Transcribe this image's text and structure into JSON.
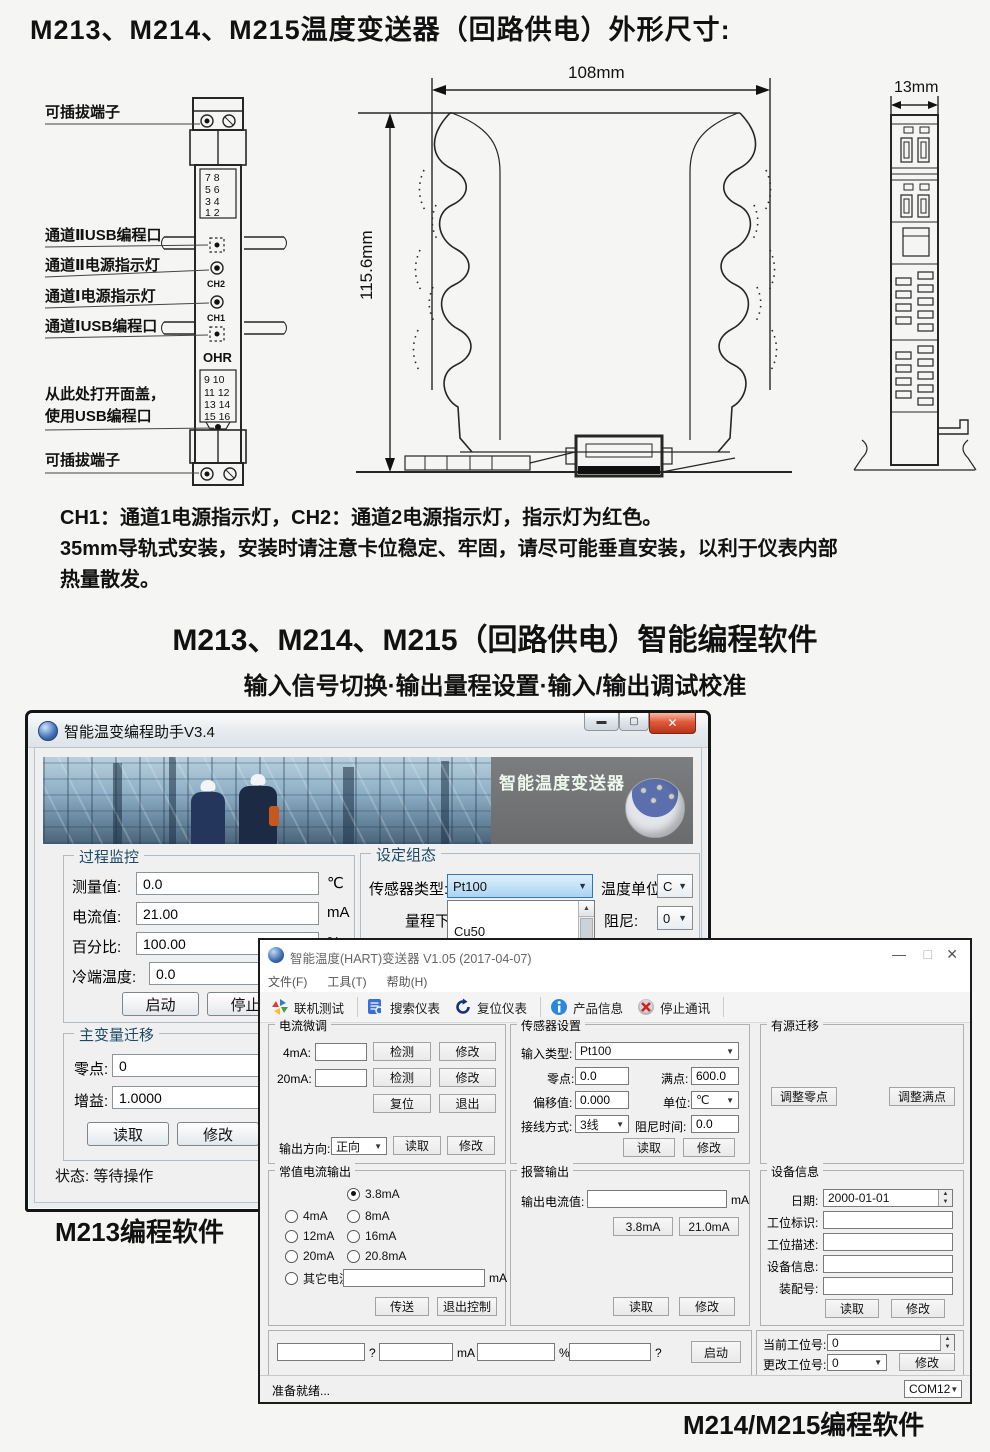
{
  "page": {
    "title": "M213、M214、M215温度变送器（回路供电）外形尺寸:",
    "notes": [
      "CH1：通道1电源指示灯，CH2：通道2电源指示灯，指示灯为红色。",
      "35mm导轨式安装，安装时请注意卡位稳定、牢固，请尽可能垂直安装，以利于仪表内部",
      "热量散发。"
    ],
    "software_title": "M213、M214、M215（回路供电）智能编程软件",
    "software_subtitle": "输入信号切换·输出量程设置·输入/输出调试校准",
    "caption_m213": "M213编程软件",
    "caption_m214": "M214/M215编程软件"
  },
  "diagram": {
    "dim_width": "108mm",
    "dim_height": "115.6mm",
    "dim_side": "13mm",
    "labels": {
      "plug_top": "可插拔端子",
      "ch2_usb": "通道ⅡUSB编程口",
      "ch2_led": "通道Ⅱ电源指示灯",
      "ch1_led": "通道Ⅰ电源指示灯",
      "ch1_usb": "通道ⅠUSB编程口",
      "open_cover1": "从此处打开面盖，",
      "open_cover2": "使用USB编程口",
      "plug_bottom": "可插拔端子"
    },
    "module": {
      "ch2": "CH2",
      "ch1": "CH1",
      "logo": "OHR",
      "top_terms": [
        "7   8",
        "5   6",
        "3   4",
        "1   2"
      ],
      "bot_terms": [
        "9   10",
        "11  12",
        "13  14",
        "15  16"
      ]
    }
  },
  "win1": {
    "title": "智能温变编程助手V3.4",
    "banner_caption": "智能温度变送器",
    "monitor": {
      "legend": "过程监控",
      "rows": [
        {
          "label": "测量值:",
          "value": "0.0",
          "unit": "℃"
        },
        {
          "label": "电流值:",
          "value": "21.00",
          "unit": "mA"
        },
        {
          "label": "百分比:",
          "value": "100.00",
          "unit": "%"
        },
        {
          "label": "冷端温度:",
          "value": "0.0",
          "unit": ""
        }
      ],
      "btn_start": "启动",
      "btn_stop": "停止"
    },
    "config": {
      "legend": "设定组态",
      "sensor_label": "传感器类型:",
      "sensor_value": "Pt100",
      "unit_label": "温度单位",
      "unit_value": "C",
      "range_label": "量程下限:",
      "damp_label": "阻尼:",
      "damp_value": "0",
      "list_items": [
        "Cu50",
        "Pt100"
      ]
    },
    "shift": {
      "legend": "主变量迁移",
      "zero_label": "零点:",
      "zero_value": "0",
      "gain_label": "增益:",
      "gain_value": "1.0000",
      "btn_read": "读取",
      "btn_modify": "修改"
    },
    "status_label": "状态:",
    "status_value": "等待操作"
  },
  "win2": {
    "title": "智能温度(HART)变送器 V1.05 (2017-04-07)",
    "controls": {
      "min": "—",
      "max": "□",
      "close": "✕"
    },
    "menus": [
      "文件(F)",
      "工具(T)",
      "帮助(H)"
    ],
    "toolbar": [
      "联机测试",
      "搜索仪表",
      "复位仪表",
      "产品信息",
      "停止通讯"
    ],
    "trim": {
      "legend": "电流微调",
      "r1_label": "4mA:",
      "r2_label": "20mA:",
      "btn_detect": "检测",
      "btn_modify": "修改",
      "btn_reset": "复位",
      "btn_exit": "退出",
      "dir_label": "输出方向:",
      "dir_value": "正向",
      "btn_read": "读取"
    },
    "sensor": {
      "legend": "传感器设置",
      "type_label": "输入类型:",
      "type_value": "Pt100",
      "zero_label": "零点:",
      "zero_value": "0.0",
      "full_label": "满点:",
      "full_value": "600.0",
      "offset_label": "偏移值:",
      "offset_value": "0.000",
      "unit_label": "单位:",
      "unit_value": "℃",
      "wire_label": "接线方式:",
      "wire_value": "3线",
      "damp_label": "阻尼时间:",
      "damp_value": "0.0",
      "btn_read": "读取",
      "btn_modify": "修改"
    },
    "active": {
      "legend": "有源迁移",
      "btn_zero": "调整零点",
      "btn_full": "调整满点"
    },
    "constant": {
      "legend": "常值电流输出",
      "options": [
        {
          "label": "3.8mA"
        },
        {
          "label": "4mA"
        },
        {
          "label": "8mA"
        },
        {
          "label": "12mA"
        },
        {
          "label": "16mA"
        },
        {
          "label": "20mA"
        },
        {
          "label": "20.8mA"
        },
        {
          "label": "其它电流"
        }
      ],
      "other_unit": "mA",
      "btn_send": "传送",
      "btn_exit": "退出控制"
    },
    "alarm": {
      "legend": "报警输出",
      "out_label": "输出电流值:",
      "out_unit": "mA",
      "btn_low": "3.8mA",
      "btn_high": "21.0mA",
      "btn_read": "读取",
      "btn_modify": "修改"
    },
    "device": {
      "legend": "设备信息",
      "date_label": "日期:",
      "date_value": "2000-01-01",
      "f1": "工位标识:",
      "f2": "工位描述:",
      "f3": "设备信息:",
      "f4": "装配号:",
      "btn_read": "读取",
      "btn_modify": "修改"
    },
    "bottom": {
      "sep1": "?",
      "sep2": "mA",
      "sep3": "%",
      "sep4": "?",
      "btn_start": "启动",
      "cur_label": "当前工位号:",
      "cur_value": "0",
      "chg_label": "更改工位号:",
      "chg_value": "0",
      "btn_modify": "修改"
    },
    "statusbar": {
      "ready": "准备就绪...",
      "com": "COM12"
    }
  }
}
